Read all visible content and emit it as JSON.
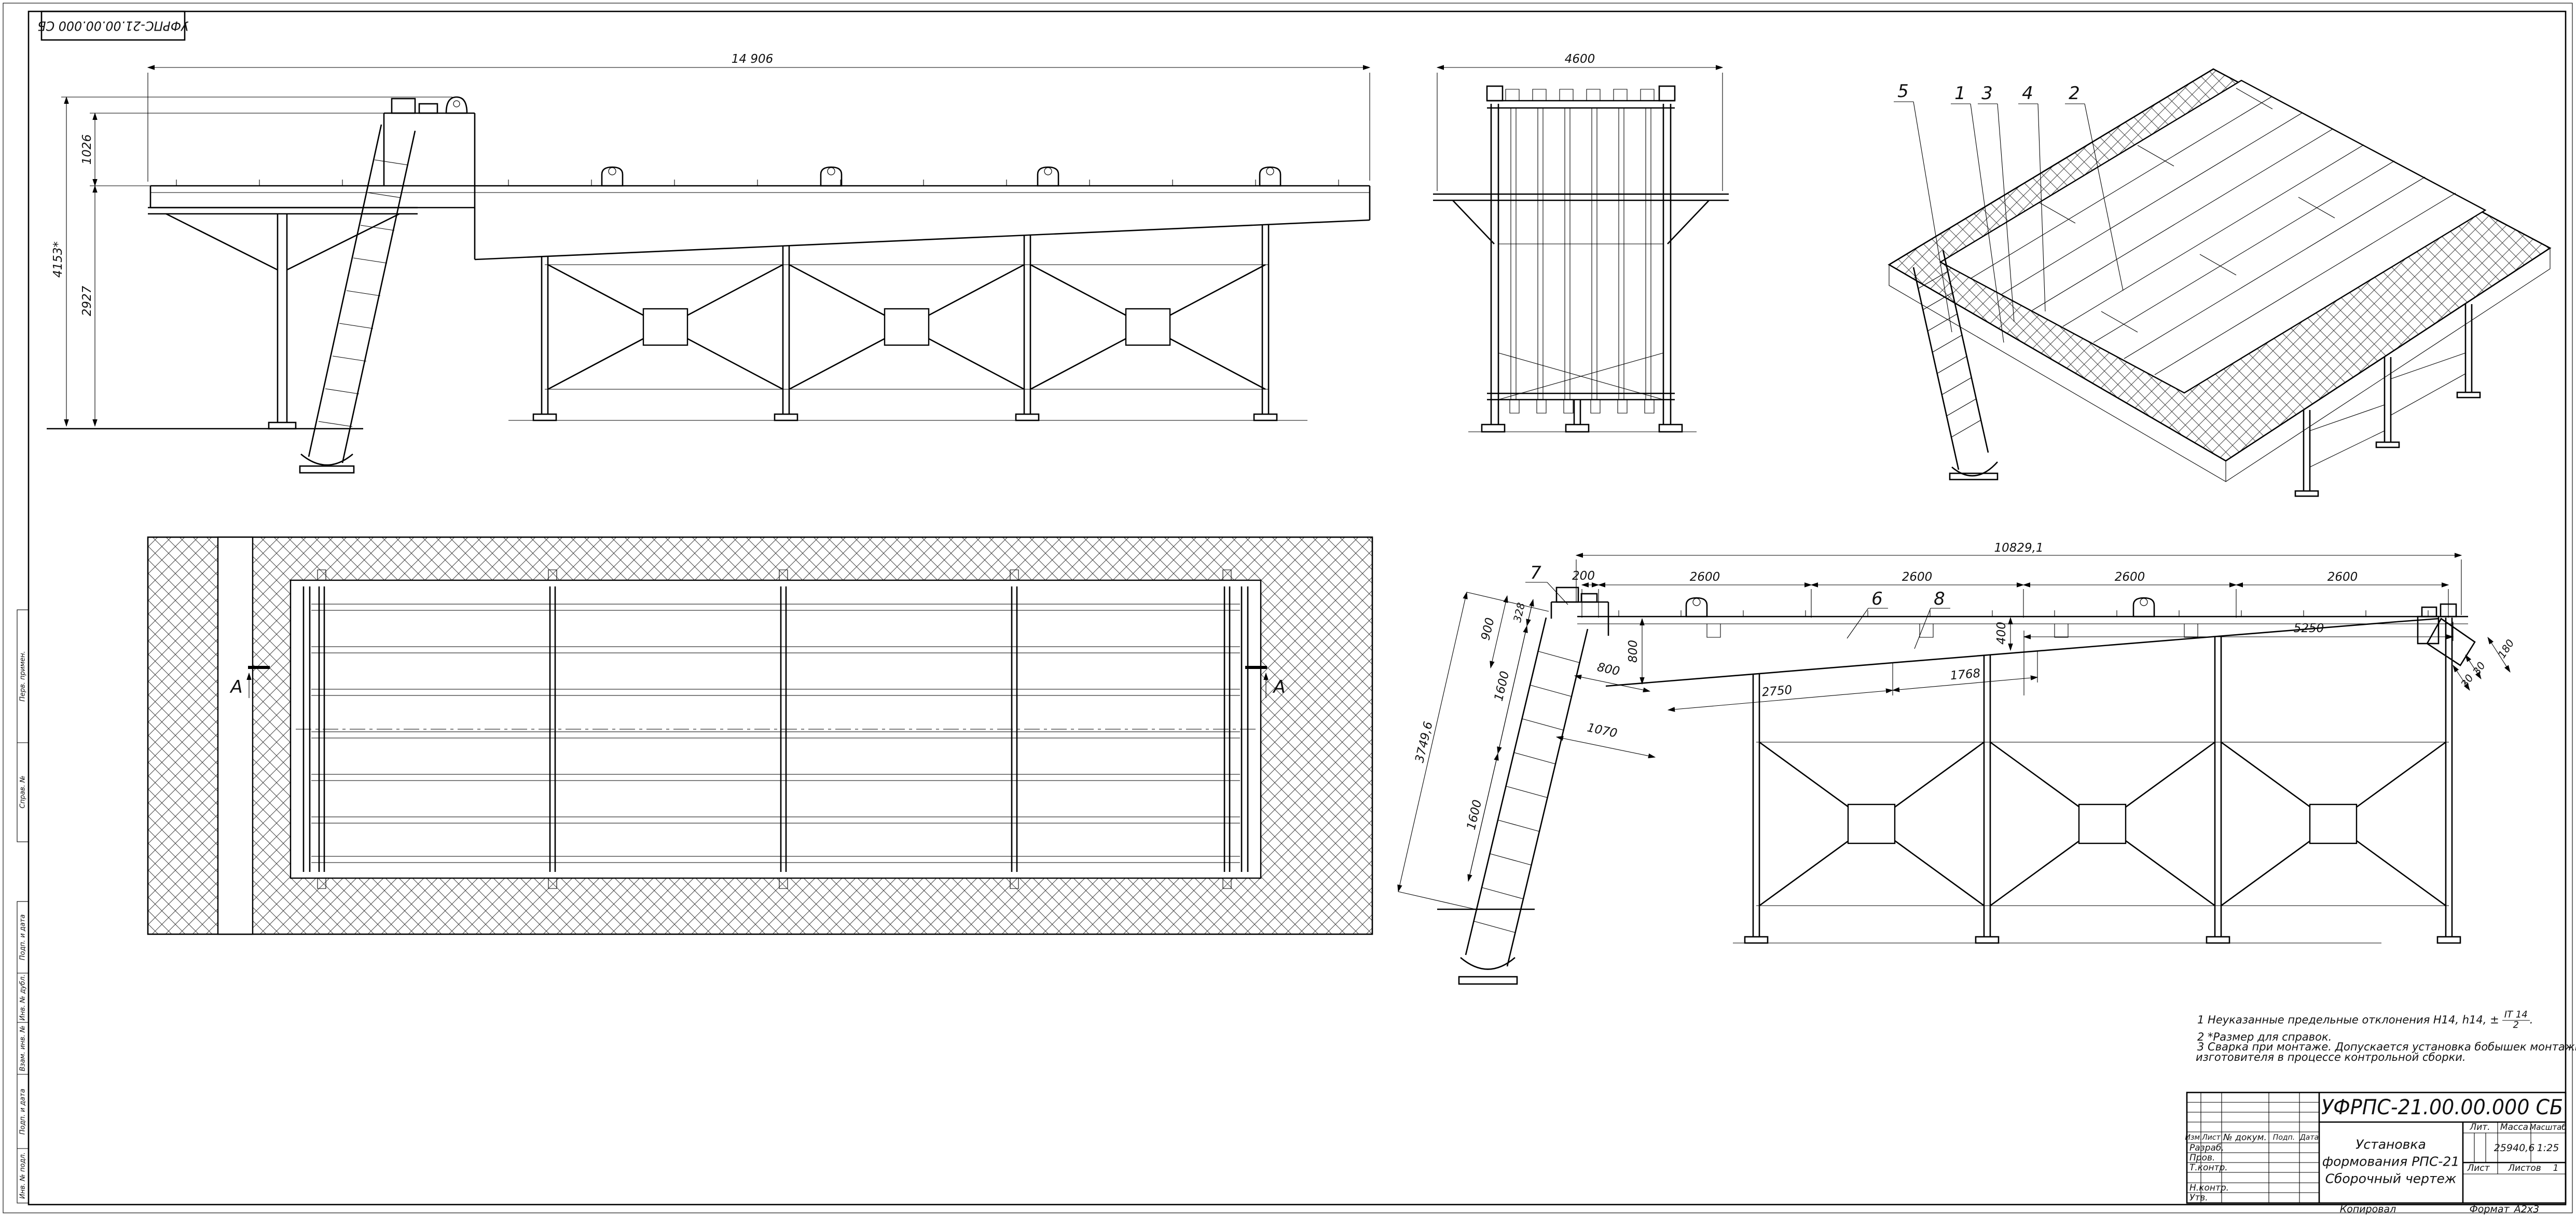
{
  "sheet": {
    "corner_stamp": "УФРПС-21.00.00.000 СБ",
    "footer_copied": "Копировал",
    "footer_format_label": "Формат",
    "footer_format_value": "А2х3"
  },
  "margin_labels": {
    "perv_primen": "Перв. примен.",
    "sprav_no": "Справ. №",
    "podp_data_1": "Подп. и дата",
    "inv_dubl": "Инв. № дубл.",
    "vzam_inv": "Взам. инв. №",
    "podp_data_2": "Подп. и дата",
    "inv_podl": "Инв. № подл."
  },
  "side_view": {
    "dim_length": "14 906",
    "dim_height": "4153*",
    "dim_upper": "1026",
    "dim_lower": "2927"
  },
  "end_view": {
    "dim_width": "4600"
  },
  "iso_view": {
    "callout_5": "5",
    "callout_1": "1",
    "callout_3": "3",
    "callout_4": "4",
    "callout_2": "2"
  },
  "plan_view": {
    "section_left": "А",
    "section_right": "А"
  },
  "detail_view": {
    "dim_total": "10829,1",
    "dim_200": "200",
    "dim_2600_1": "2600",
    "dim_2600_2": "2600",
    "dim_2600_3": "2600",
    "dim_2600_4": "2600",
    "dim_5250": "5250",
    "dim_400": "400",
    "dim_3749": "3749,6",
    "dim_900": "900",
    "dim_328": "328",
    "dim_1600_upper": "1600",
    "dim_800_incline": "800",
    "dim_800_vert": "800",
    "dim_1070": "1070",
    "dim_1600_lower": "1600",
    "dim_2750": "2750",
    "dim_1768": "1768",
    "dim_180": "180",
    "dim_30_1": "30",
    "dim_30_2": "30",
    "callout_7": "7",
    "callout_6": "6",
    "callout_8": "8"
  },
  "notes": {
    "n1_prefix": "1  Неуказанные предельные отклонения Н14, h14, ±",
    "n1_frac_num": "IT 14",
    "n1_frac_den": "2",
    "n1_suffix": ".",
    "n2": "2  *Размер для справок.",
    "n3_line1": "3  Сварка при монтаже. Допускается установка бобышек монтажных стяжек силами предприятия",
    "n3_line2": "изготовителя в процессе контрольной сборки."
  },
  "title_block": {
    "designation": "УФРПС-21.00.00.000 СБ",
    "name_line1": "Установка",
    "name_line2": "формования РПС-21",
    "name_line3": "Сборочный чертеж",
    "col_izm": "Изм.",
    "col_list": "Лист",
    "col_doc": "№ докум.",
    "col_podp": "Подп.",
    "col_data": "Дата",
    "row_razrab": "Разраб.",
    "row_prov": "Пров.",
    "row_tkontr": "Т.контр.",
    "row_nkontr": "Н.контр.",
    "row_utv": "Утв.",
    "lit_label": "Лит.",
    "massa_label": "Масса",
    "masshtab_label": "Масштаб",
    "massa_value": "25940,6",
    "masshtab_value": "1:25",
    "list_label": "Лист",
    "listov_label": "Листов",
    "listov_value": "1"
  }
}
